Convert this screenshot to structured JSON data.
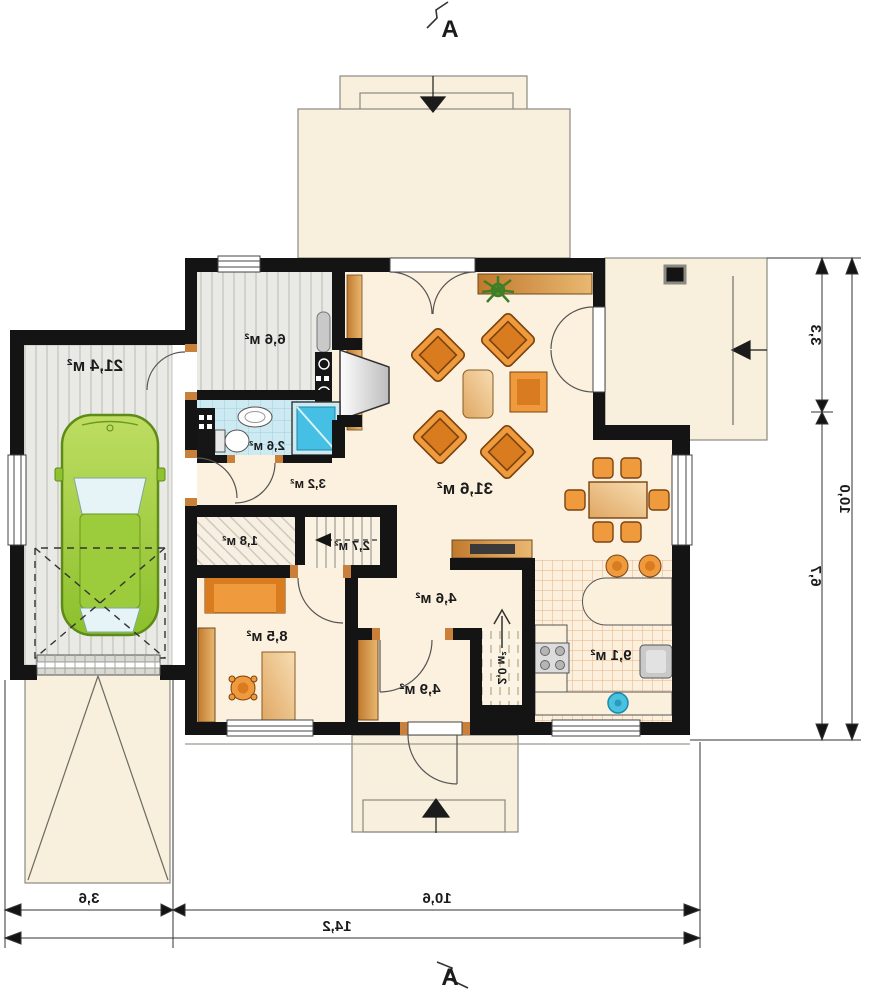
{
  "rooms": {
    "garage": {
      "label": "21,4 м²"
    },
    "boiler_room": {
      "label": "6,6 м²"
    },
    "bathroom": {
      "label": "2,6 м²"
    },
    "hallway": {
      "label": "3,2 м²"
    },
    "storage": {
      "label": "1,8 м²"
    },
    "stairs": {
      "label": "2,7 м²"
    },
    "living_room": {
      "label": "31,6 м²"
    },
    "hall": {
      "label": "4,6 м²"
    },
    "office": {
      "label": "8,5 м²"
    },
    "vestibule": {
      "label": "4,9 м²"
    },
    "pantry": {
      "label": "2,0 м²"
    },
    "kitchen": {
      "label": "9,1 м²"
    }
  },
  "dimensions": {
    "side": {
      "upper": "3,3",
      "lower": "6,7",
      "total": "10,0"
    },
    "bottom": {
      "garage": "3,6",
      "house": "10,6",
      "total": "14,2"
    }
  },
  "section_markers": {
    "top": "A",
    "bottom": "A"
  },
  "colors": {
    "wall": "#141414",
    "exterior_paving": "#f8efdc",
    "interior_floor": "#fcf1de",
    "furniture_orange": "#ef9a3d",
    "wood": "#c9803a",
    "car_green": "#9ccb3b",
    "bath_tile": "#cde9f2",
    "shower_blue": "#45bfe3",
    "sink_blue": "#49c2e0",
    "kitchen_tile_line": "#e5b287",
    "gray_floor": "#e9e9e5"
  }
}
